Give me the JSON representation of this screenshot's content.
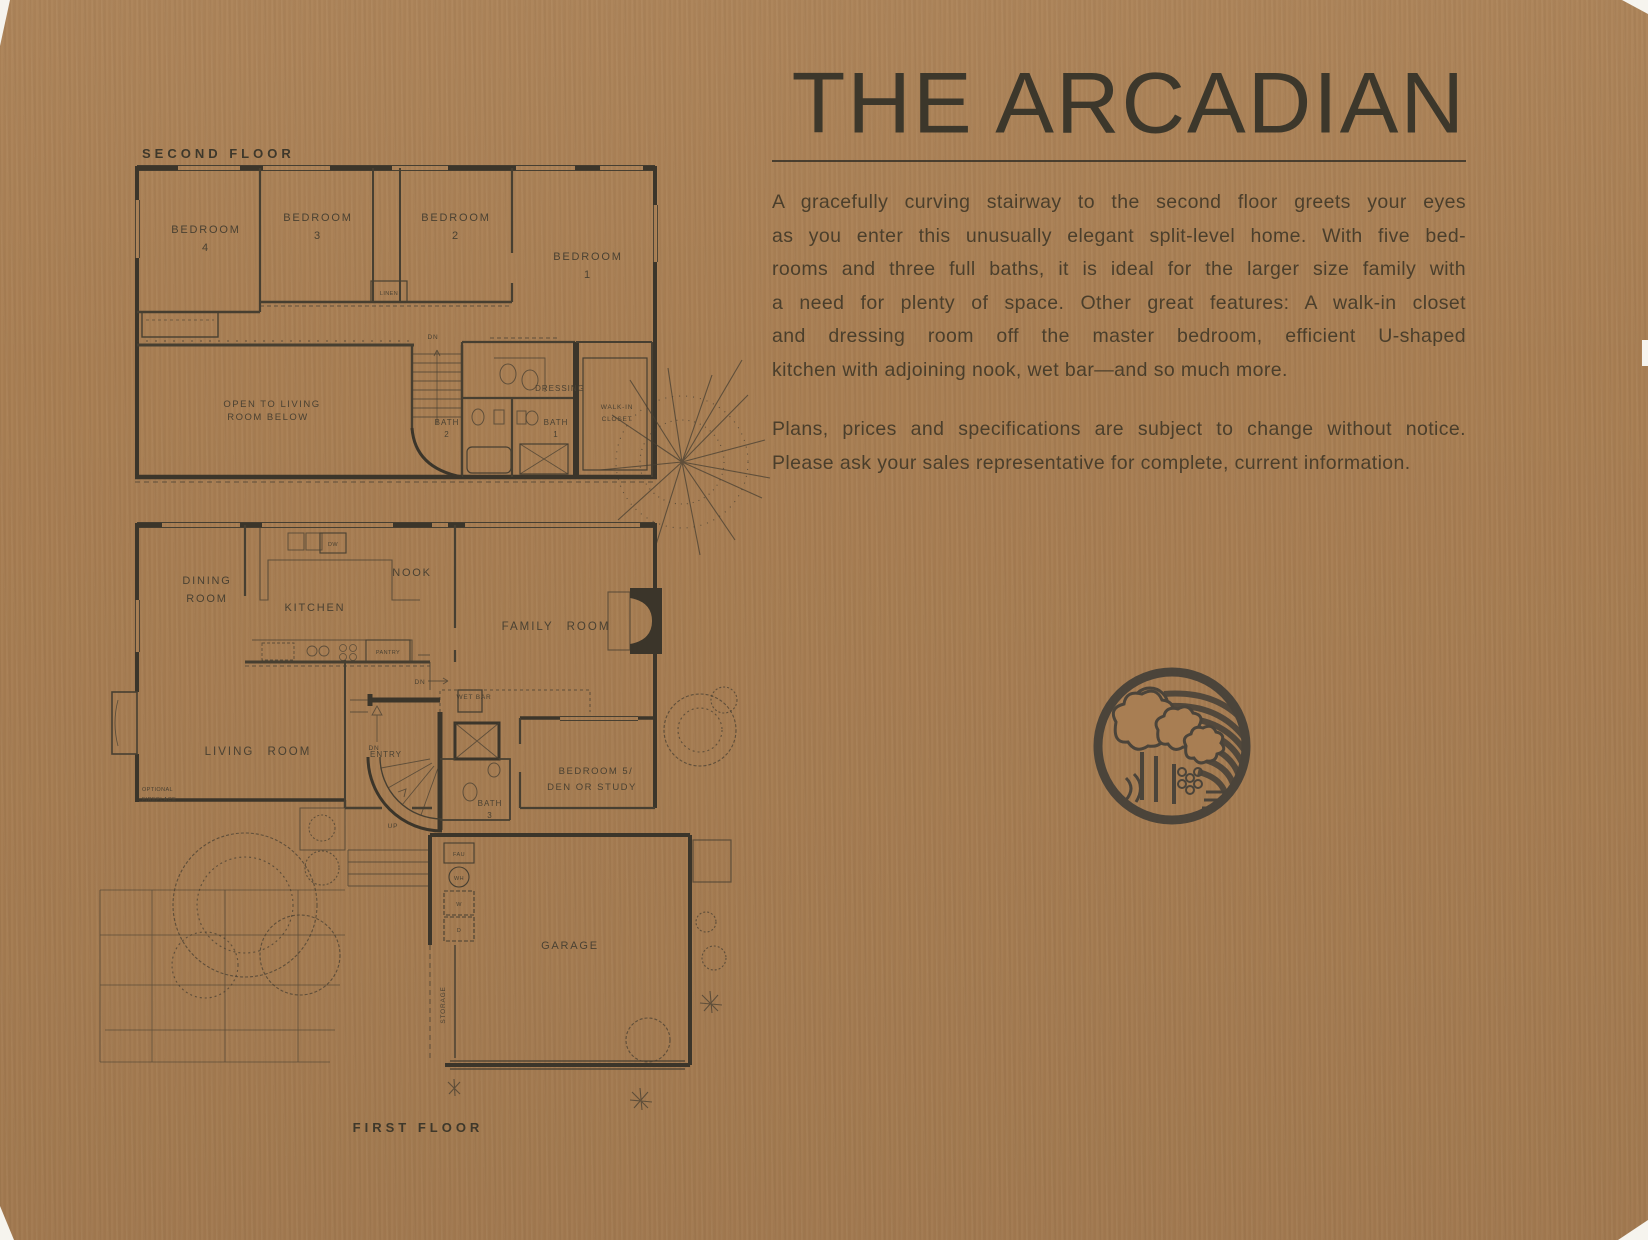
{
  "header": {
    "title": "THE ARCADIAN",
    "description_lines": [
      "A gracefully curving stairway to the second floor greets your eyes",
      "as you enter this unusually elegant split-level home. With five bed-",
      "rooms and three full baths, it is ideal for the larger size family with",
      "a need for plenty of space. Other great features: A walk-in closet",
      "and dressing room off the master bedroom, efficient U-shaped",
      "kitchen with adjoining nook, wet bar—and so much more."
    ],
    "disclaimer_lines": [
      "Plans, prices and specifications are subject to change without notice.",
      "Please ask your sales representative for complete, current information."
    ]
  },
  "second_floor": {
    "heading": "SECOND FLOOR",
    "labels": {
      "bedroom4": [
        "BEDROOM",
        "4"
      ],
      "bedroom3": [
        "BEDROOM",
        "3"
      ],
      "bedroom2": [
        "BEDROOM",
        "2"
      ],
      "bedroom1": [
        "BEDROOM",
        "1"
      ],
      "linen": "LINEN",
      "open_to_below": [
        "OPEN TO LIVING",
        "ROOM BELOW"
      ],
      "down": "DN",
      "bath2": [
        "BATH",
        "2"
      ],
      "bath1": [
        "BATH",
        "1"
      ],
      "dressing": "DRESSING",
      "walk_in_closet": [
        "WALK-IN",
        "CLOSET"
      ]
    }
  },
  "first_floor": {
    "heading": "FIRST FLOOR",
    "labels": {
      "dining_room": [
        "DINING",
        "ROOM"
      ],
      "kitchen": "KITCHEN",
      "nook": "NOOK",
      "pantry": "PANTRY",
      "dishwasher": "DW",
      "family_room": "FAMILY ROOM",
      "living_room": "LIVING ROOM",
      "optional_fireplace": [
        "OPTIONAL",
        "FIREPLACE"
      ],
      "entry": "ENTRY",
      "wet_bar": "WET BAR",
      "down_nook": "DN",
      "down_entry": "DN",
      "up": "UP",
      "bedroom5": [
        "BEDROOM 5/",
        "DEN OR STUDY"
      ],
      "bath3": [
        "BATH",
        "3"
      ],
      "fau": "FAU",
      "water_heater": "WH",
      "washer": "W",
      "dryer": "D",
      "garage": "GARAGE",
      "storage": "STORAGE"
    }
  },
  "logo": {
    "icon": "farm-orchard-circle-logo"
  }
}
